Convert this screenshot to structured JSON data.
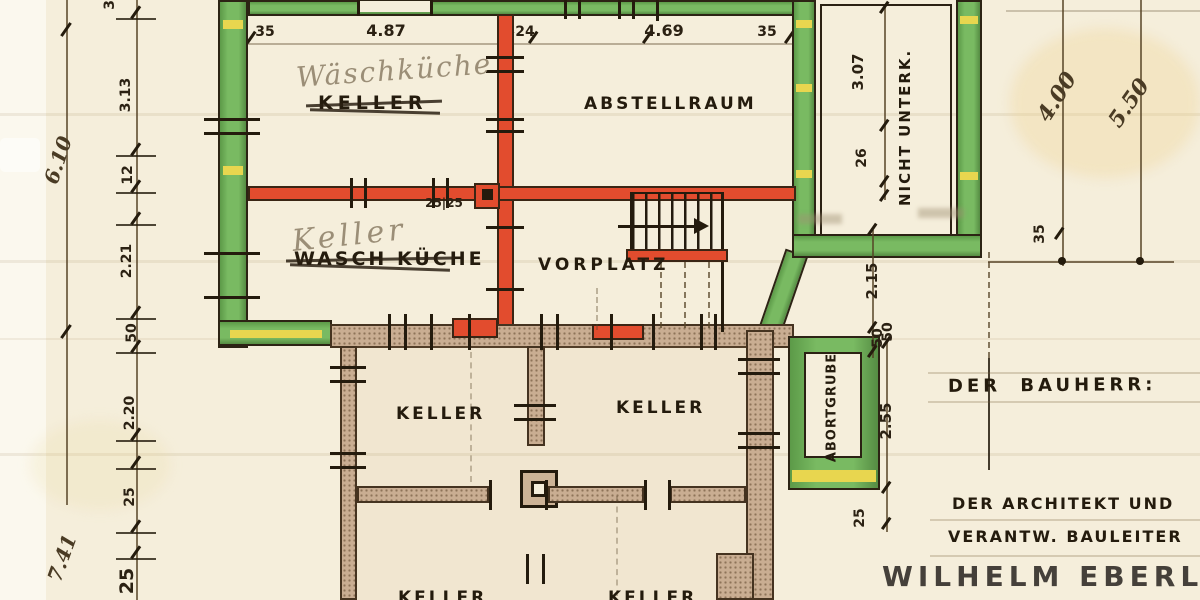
{
  "plan": {
    "rooms": {
      "upper_left": {
        "pencil": "Wäschküche",
        "printed": "KELLER"
      },
      "upper_right": {
        "printed": "ABSTELLRAUM"
      },
      "mid_left": {
        "pencil": "Keller",
        "printed": "WASCH KÜCHE"
      },
      "hall": {
        "printed": "VORPLATZ"
      },
      "lower_left": {
        "printed": "KELLER"
      },
      "lower_right": {
        "printed": "KELLER"
      },
      "bottom_left": {
        "printed": "KELLER"
      },
      "bottom_right": {
        "printed": "KELLER"
      },
      "annex": {
        "printed": "NICHT UNTERK."
      },
      "pit": {
        "printed": "ABORTGRUBE"
      }
    },
    "dims": {
      "top": [
        "35",
        "4.87",
        "24",
        "4.69",
        "35"
      ],
      "left_outer": [
        "6.10",
        "7.41"
      ],
      "left_inner": [
        "35",
        "3.13",
        "12",
        "2.21",
        "50",
        "2.20",
        "25",
        "25"
      ],
      "annex_v": [
        "3.07",
        "26"
      ],
      "right_hand": [
        "4.00",
        "5.50"
      ],
      "right_35": "35",
      "mid": [
        "2.15",
        "50"
      ],
      "column": "25|25",
      "pit": [
        "50",
        "2.55",
        "25"
      ]
    },
    "titles": {
      "bauherr": "DER BAUHERR:",
      "architect_role_1": "DER ARCHITEKT UND",
      "architect_role_2": "VERANTW. BAULEITER",
      "architect_name": "WILHELM EBERLE"
    },
    "colors": {
      "paper": "#f5eedb",
      "new_wall_green": "#6fae58",
      "demolition_red": "#e24c2e",
      "existing_wall_grey": "#c9ad92",
      "window_yellow": "#e8d64f",
      "ink": "#241b0d",
      "pencil": "#9b8e77"
    }
  }
}
